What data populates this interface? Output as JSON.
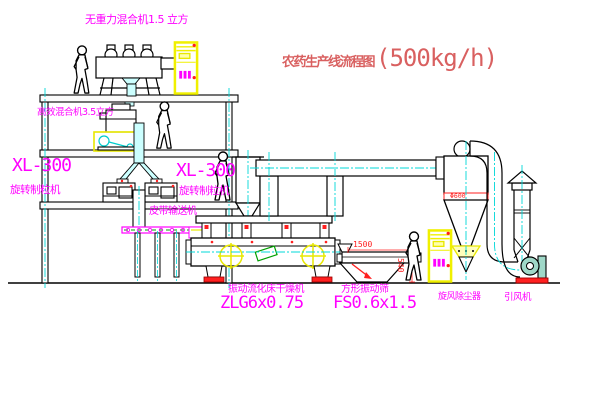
{
  "title": {
    "name": "农药生产线流程图",
    "capacity": "(500kg/h)"
  },
  "labels": {
    "gravity_mixer": "无重力混合机1.5 立方",
    "high_mixer": "高效混合机3.5立方",
    "granulator_left_model": "XL-300",
    "granulator_left_name": "旋转制粒机",
    "granulator_center_model": "XL-300",
    "granulator_center_name": "旋转制粒机",
    "belt_conveyor": "皮带输送机",
    "dryer_name": "振动流化床干燥机",
    "dryer_model": "ZLG6x0.75",
    "sieve_name": "方形振动筛",
    "sieve_model": "FS0.6x1.5",
    "cyclone": "旋风除尘器",
    "fan": "引风机"
  },
  "dimensions": {
    "cyclone_band": "Φ600",
    "sieve_width": "1500",
    "sieve_height": "540"
  },
  "colors": {
    "label_magenta": "#ff00ff",
    "title_red": "#d96060",
    "dimension_red": "#ff2020",
    "cabinet_yellow": "#f0f000",
    "centerline_cyan": "#00d8d8",
    "accent_green": "#00a000",
    "machine_line": "#000000"
  }
}
